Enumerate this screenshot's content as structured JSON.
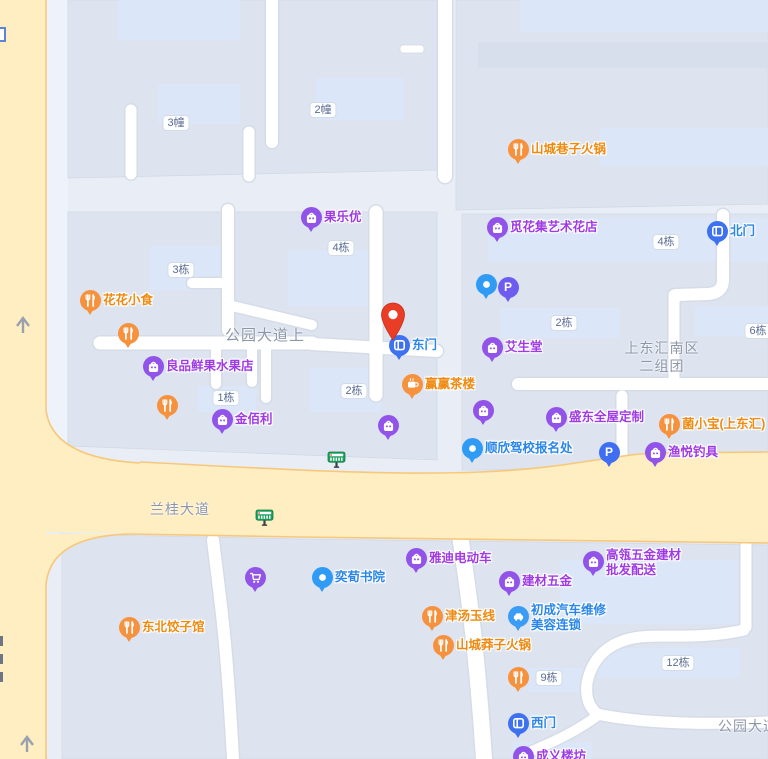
{
  "map": {
    "colors": {
      "marker_orange": "#f6913d",
      "marker_purple": "#9254e8",
      "marker_blue": "#2f9bf5",
      "marker_gate_blue": "#3d71ef",
      "marker_parking_indigo": "#6e5cf0",
      "marker_parking_blue": "#3f6ef2",
      "marker_car_blue": "#3b9cf5",
      "text_orange": "#ee8a10",
      "text_purple": "#9e3be4",
      "text_blue": "#2a86e8",
      "text_gray": "#8d96a9",
      "pin_red": "#e93d25",
      "road_yellow": "#ffeec1",
      "road_border": "#f7c87c",
      "bus_green": "#1ea05f"
    },
    "road_labels": [
      {
        "text": "公园大道上",
        "x": 225,
        "y": 324,
        "size": 15
      },
      {
        "text": "兰桂大道",
        "x": 150,
        "y": 499,
        "size": 14
      },
      {
        "text": "公园大道",
        "x": 718,
        "y": 716,
        "size": 14
      }
    ],
    "area_labels": [
      {
        "lines": [
          "上东汇南区",
          "二组团"
        ],
        "x": 662,
        "y": 339
      }
    ],
    "building_badges": [
      {
        "text": "3幢",
        "x": 176,
        "y": 123
      },
      {
        "text": "2幢",
        "x": 323,
        "y": 110
      },
      {
        "text": "4栋",
        "x": 666,
        "y": 242
      },
      {
        "text": "4栋",
        "x": 341,
        "y": 248
      },
      {
        "text": "3栋",
        "x": 181,
        "y": 270
      },
      {
        "text": "2栋",
        "x": 354,
        "y": 391
      },
      {
        "text": "1栋",
        "x": 226,
        "y": 398
      },
      {
        "text": "2栋",
        "x": 564,
        "y": 323
      },
      {
        "text": "6栋",
        "x": 758,
        "y": 331
      },
      {
        "text": "9栋",
        "x": 549,
        "y": 678
      },
      {
        "text": "12栋",
        "x": 678,
        "y": 663
      }
    ],
    "pois": [
      {
        "name": "山城巷子火锅",
        "icon": "restaurant-icon",
        "color": "marker_orange",
        "tcolor": "text_orange",
        "x": 518,
        "y": 149,
        "side": "right",
        "lines": [
          "山城巷子火锅"
        ]
      },
      {
        "name": "觅花集艺术花店",
        "icon": "shop-bag-icon",
        "color": "marker_purple",
        "tcolor": "text_purple",
        "x": 497,
        "y": 227,
        "side": "right",
        "lines": [
          "觅花集艺术花店"
        ]
      },
      {
        "name": "北门",
        "icon": "gate-icon",
        "color": "marker_gate_blue",
        "tcolor": "text_blue",
        "x": 717,
        "y": 231,
        "side": "right",
        "lines": [
          "北门"
        ]
      },
      {
        "name": "果乐优",
        "icon": "shop-bag-icon",
        "color": "marker_purple",
        "tcolor": "text_purple",
        "x": 311,
        "y": 217,
        "side": "right",
        "lines": [
          "果乐优"
        ]
      },
      {
        "name": "小鹏文化艺术",
        "icon": "dot-icon",
        "color": "marker_blue",
        "tcolor": "text_blue",
        "x": 486,
        "y": 284,
        "side": "left",
        "lines": [
          "小鹏文化艺术"
        ]
      },
      {
        "name": "停车场",
        "icon": "parking-icon",
        "color": "marker_parking_indigo",
        "tcolor": "text_blue",
        "x": 508,
        "y": 287,
        "side": "right",
        "lines": []
      },
      {
        "name": "花花小食",
        "icon": "restaurant-icon",
        "color": "marker_orange",
        "tcolor": "text_orange",
        "x": 90,
        "y": 300,
        "side": "right",
        "lines": [
          "花花小食"
        ]
      },
      {
        "name": "东北食府",
        "icon": "restaurant-icon",
        "color": "marker_orange",
        "tcolor": "text_orange",
        "x": 128,
        "y": 333,
        "side": "left",
        "lines": [
          "东北食府"
        ]
      },
      {
        "name": "良品鲜果水果店",
        "icon": "shop-bag-icon",
        "color": "marker_purple",
        "tcolor": "text_purple",
        "x": 153,
        "y": 366,
        "side": "right",
        "lines": [
          "良品鲜果水果店"
        ]
      },
      {
        "name": "艾生堂",
        "icon": "shop-bag-icon",
        "color": "marker_purple",
        "tcolor": "text_purple",
        "x": 492,
        "y": 347,
        "side": "right",
        "lines": [
          "艾生堂"
        ]
      },
      {
        "name": "东门",
        "icon": "gate-icon",
        "color": "marker_gate_blue",
        "tcolor": "text_blue",
        "x": 399,
        "y": 345,
        "side": "right",
        "lines": [
          "东门"
        ]
      },
      {
        "name": "赢赢茶楼",
        "icon": "teacup-icon",
        "color": "marker_orange",
        "tcolor": "text_orange",
        "x": 412,
        "y": 384,
        "side": "right",
        "lines": [
          "赢赢茶楼"
        ]
      },
      {
        "name": "川湘阁串串",
        "icon": "restaurant-icon",
        "color": "marker_orange",
        "tcolor": "text_orange",
        "x": 167,
        "y": 405,
        "side": "left",
        "lines": [
          "川湘阁串串"
        ]
      },
      {
        "name": "金佰利",
        "icon": "shop-bag-icon",
        "color": "marker_purple",
        "tcolor": "text_purple",
        "x": 222,
        "y": 419,
        "side": "right",
        "lines": [
          "金佰利"
        ]
      },
      {
        "name": "成人情趣用品",
        "icon": "shop-bag-icon",
        "color": "marker_purple",
        "tcolor": "text_purple",
        "x": 483,
        "y": 410,
        "side": "left",
        "lines": [
          "成人情趣用品"
        ]
      },
      {
        "name": "广东钰煌门窗",
        "icon": "shop-bag-icon",
        "color": "marker_purple",
        "tcolor": "text_purple",
        "x": 388,
        "y": 425,
        "side": "left",
        "lines": [
          "广东钰煌门窗"
        ]
      },
      {
        "name": "盛东全屋定制",
        "icon": "shop-bag-icon",
        "color": "marker_purple",
        "tcolor": "text_purple",
        "x": 556,
        "y": 417,
        "side": "right",
        "lines": [
          "盛东全屋定制"
        ]
      },
      {
        "name": "菌小宝(上东汇)",
        "icon": "restaurant-icon",
        "color": "marker_orange",
        "tcolor": "text_orange",
        "x": 669,
        "y": 424,
        "side": "right",
        "lines": [
          "菌小宝(上东汇)"
        ]
      },
      {
        "name": "顺欣驾校报名处",
        "icon": "dot-icon",
        "color": "marker_blue",
        "tcolor": "text_blue",
        "x": 472,
        "y": 448,
        "side": "right",
        "lines": [
          "顺欣驾校报名处"
        ]
      },
      {
        "name": "停车场",
        "icon": "parking-icon",
        "color": "marker_parking_blue",
        "tcolor": "text_blue",
        "x": 609,
        "y": 452,
        "side": "right",
        "lines": []
      },
      {
        "name": "渔悦钓具",
        "icon": "shop-bag-icon",
        "color": "marker_purple",
        "tcolor": "text_purple",
        "x": 655,
        "y": 452,
        "side": "right",
        "lines": [
          "渔悦钓具"
        ]
      },
      {
        "name": "雅迪电动车",
        "icon": "shop-bag-icon",
        "color": "marker_purple",
        "tcolor": "text_purple",
        "x": 416,
        "y": 558,
        "side": "right",
        "lines": [
          "雅迪电动车"
        ]
      },
      {
        "name": "高瓴五金建材批发配送",
        "icon": "shop-bag-icon",
        "color": "marker_purple",
        "tcolor": "text_purple",
        "x": 593,
        "y": 561,
        "side": "right",
        "lines": [
          "高瓴五金建材",
          "批发配送"
        ]
      },
      {
        "name": "誉多便利超市",
        "icon": "cart-icon",
        "color": "marker_purple",
        "tcolor": "text_purple",
        "x": 255,
        "y": 577,
        "side": "left",
        "lines": [
          "誉多便利超市"
        ]
      },
      {
        "name": "奕荀书院",
        "icon": "dot-icon",
        "color": "marker_blue",
        "tcolor": "text_blue",
        "x": 322,
        "y": 577,
        "side": "right",
        "lines": [
          "奕荀书院"
        ]
      },
      {
        "name": "建材五金",
        "icon": "shop-bag-icon",
        "color": "marker_purple",
        "tcolor": "text_purple",
        "x": 509,
        "y": 581,
        "side": "right",
        "lines": [
          "建材五金"
        ]
      },
      {
        "name": "津汤玉线",
        "icon": "restaurant-icon",
        "color": "marker_orange",
        "tcolor": "text_orange",
        "x": 432,
        "y": 616,
        "side": "right",
        "lines": [
          "津汤玉线"
        ]
      },
      {
        "name": "初成汽车维修美容连锁",
        "icon": "car-icon",
        "color": "marker_car_blue",
        "tcolor": "text_blue",
        "x": 518,
        "y": 616,
        "side": "right",
        "lines": [
          "初成汽车维修",
          "美容连锁"
        ]
      },
      {
        "name": "东北饺子馆",
        "icon": "restaurant-icon",
        "color": "marker_orange",
        "tcolor": "text_orange",
        "x": 129,
        "y": 627,
        "side": "right",
        "lines": [
          "东北饺子馆"
        ]
      },
      {
        "name": "山城莽子火锅",
        "icon": "restaurant-icon",
        "color": "marker_orange",
        "tcolor": "text_orange",
        "x": 443,
        "y": 645,
        "side": "right",
        "lines": [
          "山城莽子火锅"
        ]
      },
      {
        "name": "蒋外婆老火锅",
        "icon": "restaurant-icon",
        "color": "marker_orange",
        "tcolor": "text_orange",
        "x": 518,
        "y": 677,
        "side": "left",
        "lines": [
          "蒋外婆老火锅"
        ]
      },
      {
        "name": "西门",
        "icon": "gate-icon",
        "color": "marker_gate_blue",
        "tcolor": "text_blue",
        "x": 518,
        "y": 723,
        "side": "right",
        "lines": [
          "西门"
        ]
      },
      {
        "name": "成义楼坊",
        "icon": "shop-bag-icon",
        "color": "marker_purple",
        "tcolor": "text_purple",
        "x": 523,
        "y": 756,
        "side": "right",
        "lines": [
          "成义楼坊"
        ]
      }
    ],
    "bus_stops": [
      {
        "x": 336,
        "y": 458
      },
      {
        "x": 264,
        "y": 516
      }
    ],
    "destination_pin": {
      "x": 393,
      "y": 341
    }
  }
}
